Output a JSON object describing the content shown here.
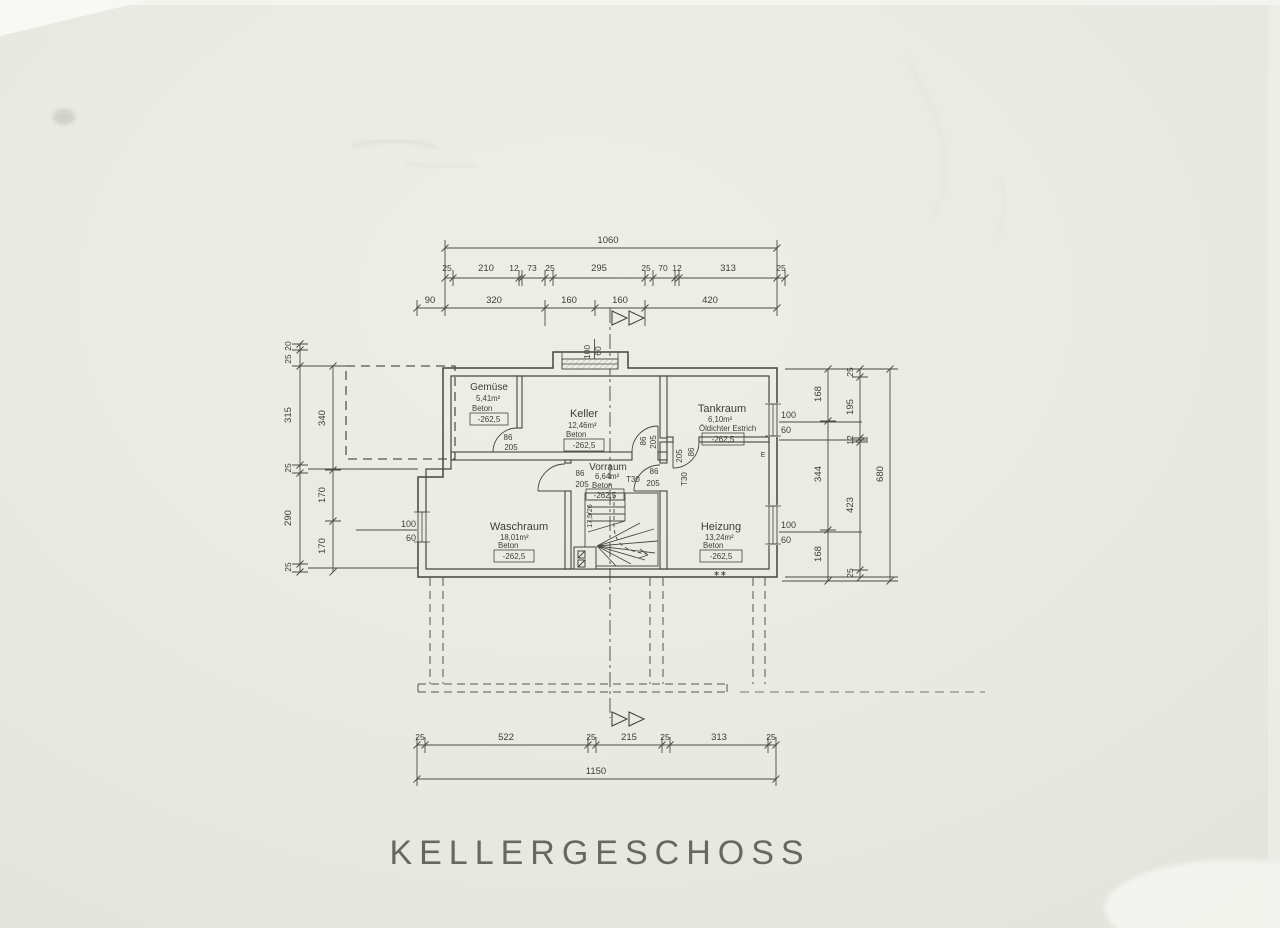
{
  "title": "KELLERGESCHOSS",
  "rooms": {
    "gemuese": {
      "name": "Gemüse",
      "area": "5,41m²",
      "floor": "Beton",
      "level": "-262,5"
    },
    "keller": {
      "name": "Keller",
      "area": "12,46m²",
      "floor": "Beton",
      "level": "-262,5"
    },
    "tankraum": {
      "name": "Tankraum",
      "area": "6,10m²",
      "floor": "Öldichter Estrich",
      "level": "-262,5"
    },
    "vorraum": {
      "name": "Vorraum",
      "area": "6,64m²",
      "floor": "Beton",
      "level": "-262,5"
    },
    "waschraum": {
      "name": "Waschraum",
      "area": "18,01m²",
      "floor": "Beton",
      "level": "-262,5"
    },
    "heizung": {
      "name": "Heizung",
      "area": "13,24m²",
      "floor": "Beton",
      "level": "-262,5"
    }
  },
  "dimensions": {
    "top_total": "1060",
    "top_detail": [
      "25",
      "210",
      "12",
      "73",
      "25",
      "295",
      "25",
      "70",
      "12",
      "313",
      "25"
    ],
    "top_main": [
      "90",
      "320",
      "160",
      "160",
      "420"
    ],
    "bottom_detail": [
      "25",
      "522",
      "25",
      "215",
      "25",
      "313",
      "25"
    ],
    "bottom_total": "1150",
    "left_outer": [
      "20",
      "25",
      "315",
      "25",
      "290",
      "25"
    ],
    "left_inner": [
      "340",
      "170",
      "170"
    ],
    "right_inner": [
      "168",
      "344",
      "168"
    ],
    "right_detail": [
      "25",
      "195",
      "12",
      "423",
      "25"
    ],
    "right_total": "680"
  },
  "openings": {
    "door_width": "86",
    "door_height": "205",
    "fire_rating": "T30",
    "window_width": "100",
    "window_height": "60"
  },
  "stairs": {
    "note": "17,5/26"
  },
  "annotations": {
    "electric": "E",
    "heizung_marks": "∗∗"
  }
}
